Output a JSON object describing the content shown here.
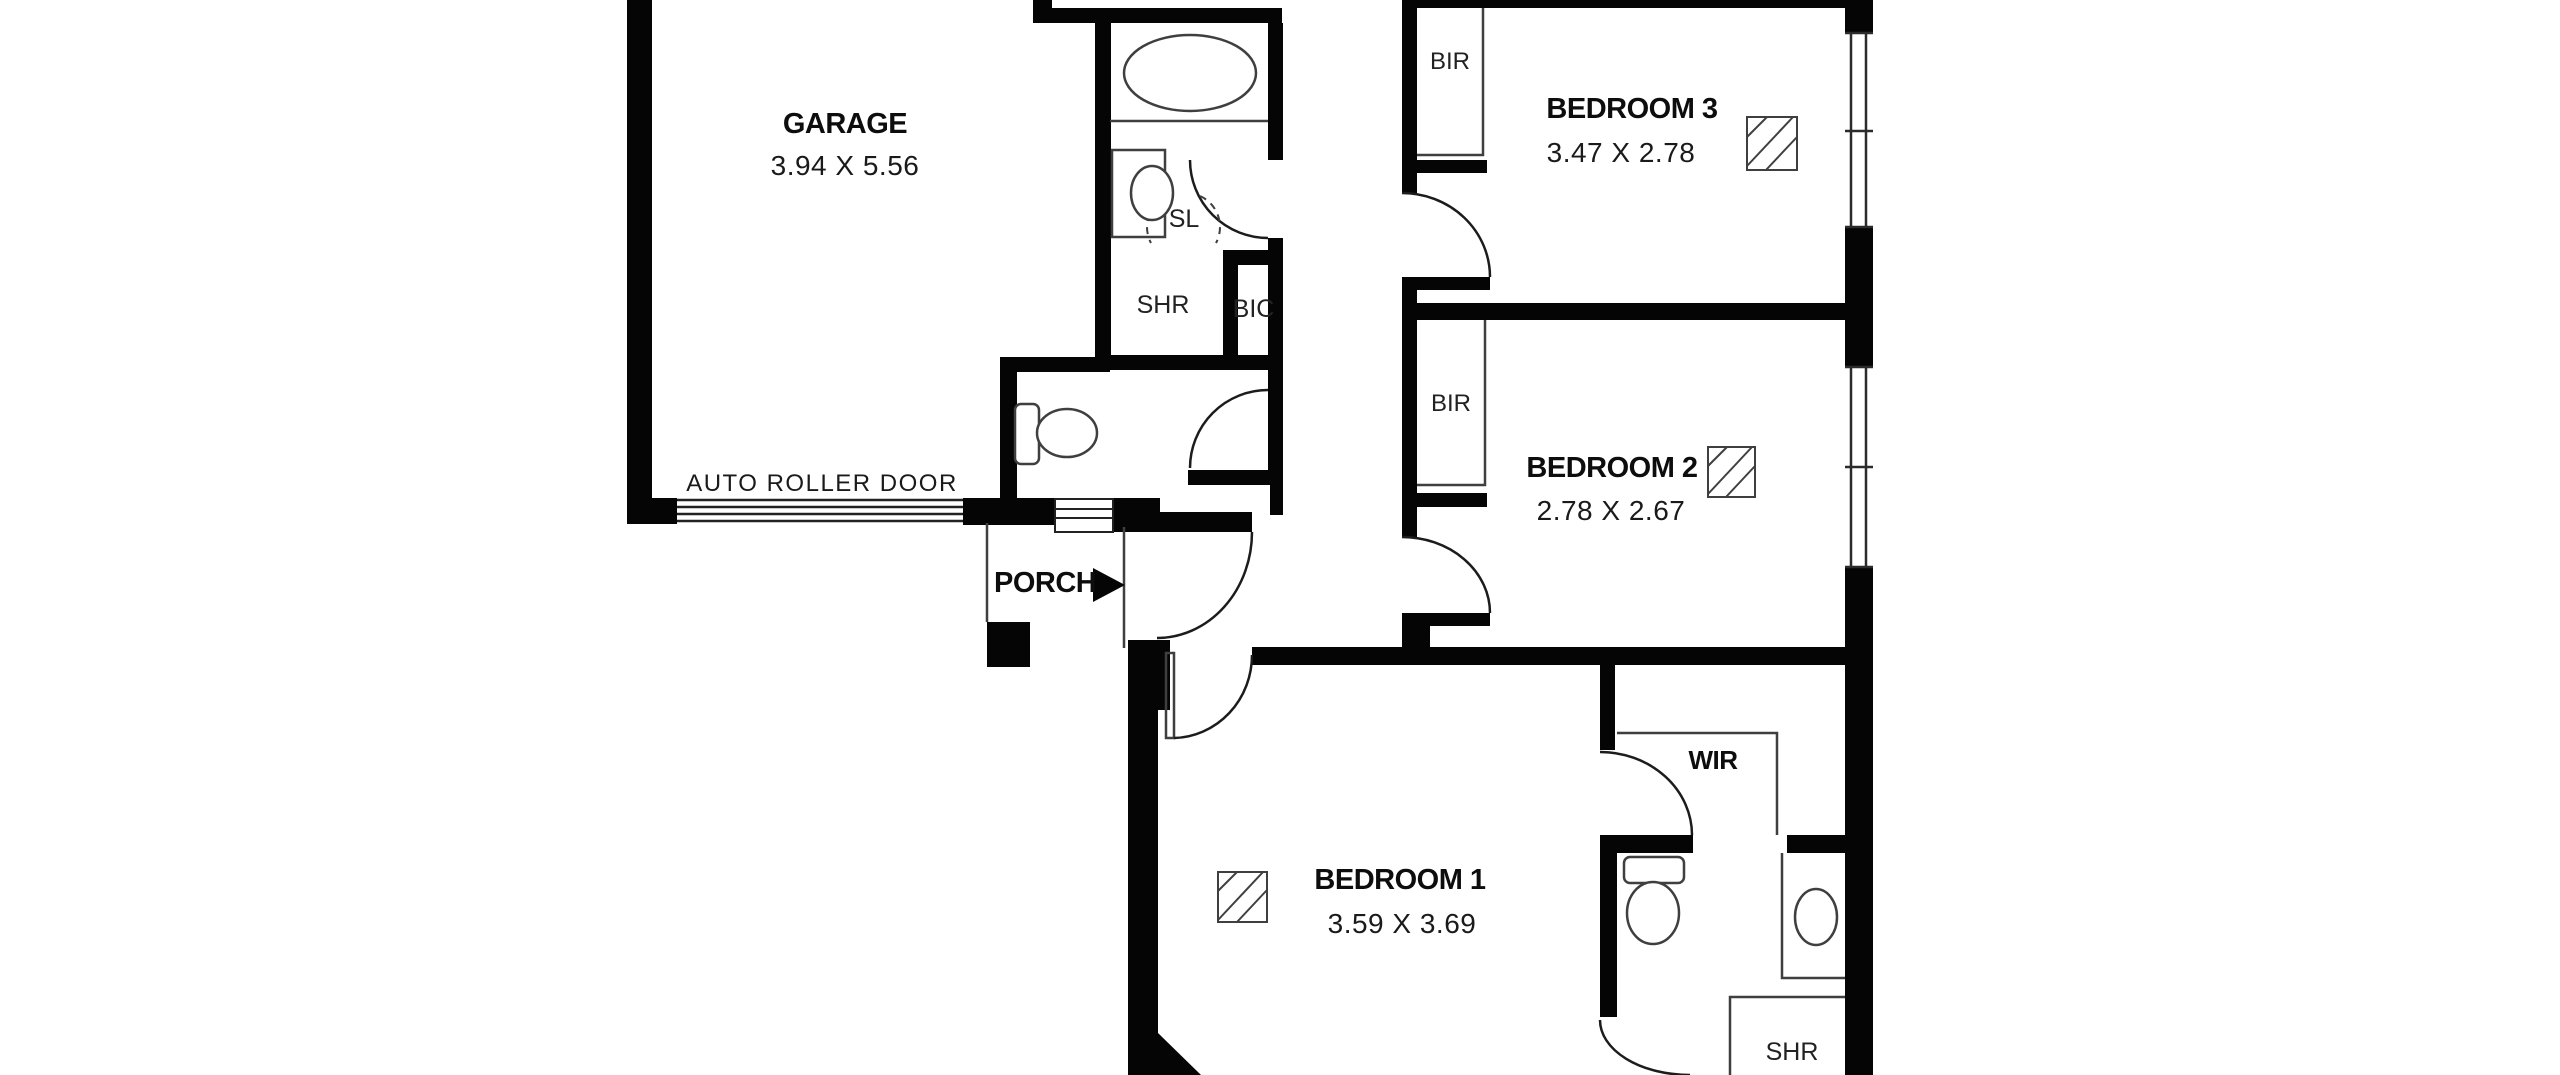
{
  "floorplan": {
    "rooms": {
      "garage": {
        "name": "GARAGE",
        "dims": "3.94 X 5.56"
      },
      "bedroom3": {
        "name": "BEDROOM 3",
        "dims": "3.47 X 2.78"
      },
      "bedroom2": {
        "name": "BEDROOM 2",
        "dims": "2.78 X 2.67"
      },
      "bedroom1": {
        "name": "BEDROOM 1",
        "dims": "3.59 X 3.69"
      },
      "porch": {
        "name": "PORCH"
      },
      "wir": {
        "name": "WIR"
      }
    },
    "labels": {
      "bir_bedroom3": "BIR",
      "bir_bedroom2": "BIR",
      "shower_main": "SHR",
      "shower_ensuite": "SHR",
      "built_in_cupboard": "BIC",
      "linen_sl": "SL",
      "auto_roller_door": "AUTO ROLLER DOOR"
    },
    "fixtures": [
      "bathtub",
      "vanity-basin",
      "toilet",
      "toilet",
      "vanity-basin",
      "ceiling-fan",
      "ceiling-fan",
      "ceiling-fan",
      "entry-arrow"
    ],
    "colors": {
      "wall": "#050505",
      "background": "#ffffff",
      "fixture_line": "#4a4a4a",
      "text": "#111111"
    }
  }
}
